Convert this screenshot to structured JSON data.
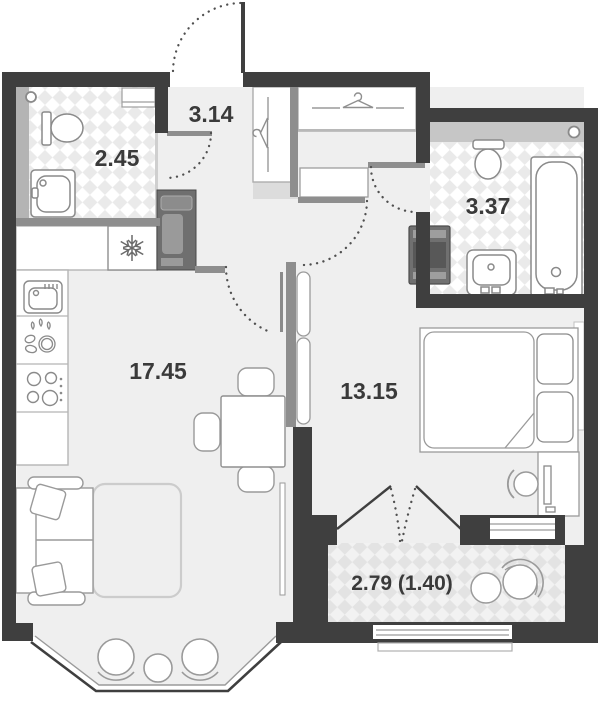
{
  "plan": {
    "colors": {
      "background": "#ffffff",
      "wall": "#3f3f3f",
      "wall_light": "#8e8e8e",
      "floor": "#efefef",
      "tile_check": "#eaeaea",
      "balcony_check": "#e3e3e3",
      "label": "#3a3a3a"
    },
    "rooms": [
      {
        "id": "entrance-hall",
        "label": "3.14"
      },
      {
        "id": "bathroom-small",
        "label": "2.45"
      },
      {
        "id": "bathroom-large",
        "label": "3.37"
      },
      {
        "id": "kitchen-living-room",
        "label": "17.45"
      },
      {
        "id": "bedroom",
        "label": "13.15"
      },
      {
        "id": "balcony",
        "label": "2.79 (1.40)"
      }
    ]
  }
}
